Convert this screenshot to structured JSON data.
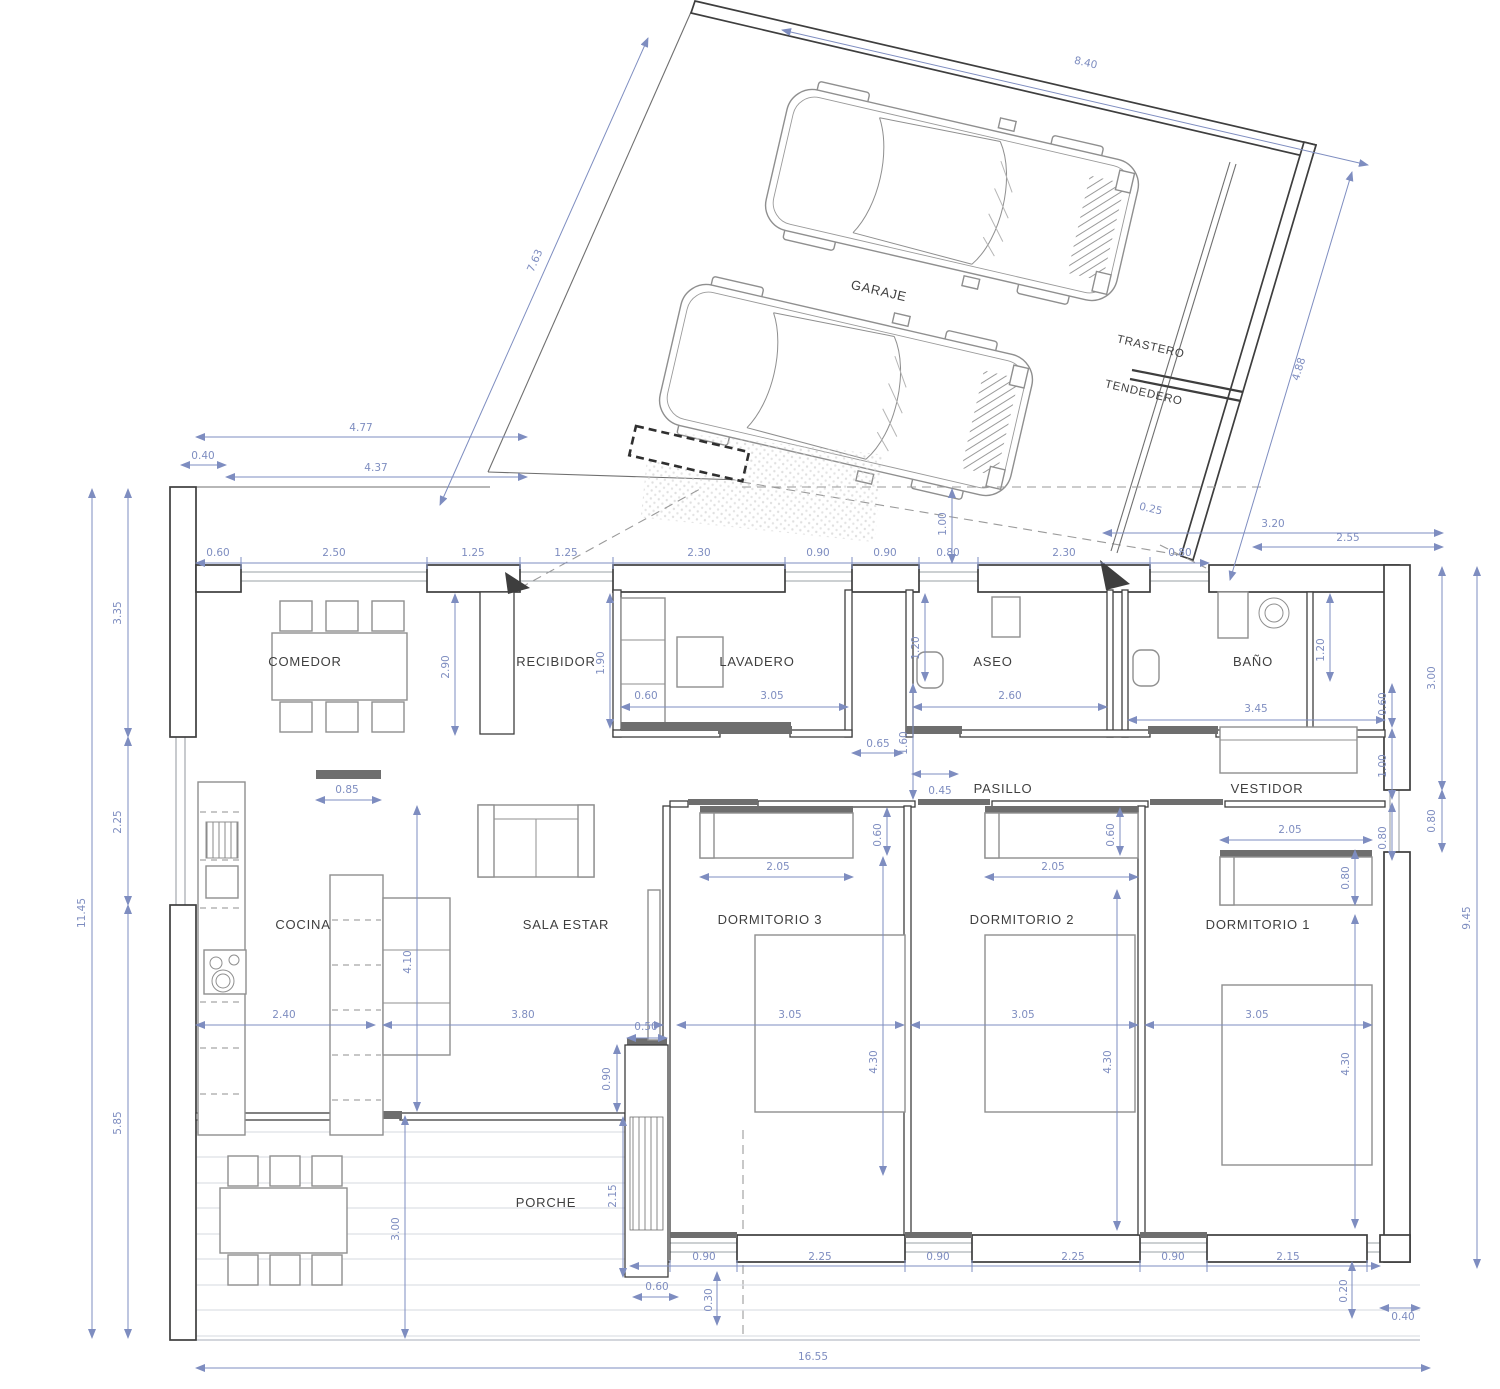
{
  "rooms": {
    "garaje": "GARAJE",
    "trastero": "TRASTERO",
    "tendedero": "TENDEDERO",
    "comedor": "COMEDOR",
    "recibidor": "RECIBIDOR",
    "lavadero": "LAVADERO",
    "aseo": "ASEO",
    "bano": "BAÑO",
    "pasillo": "PASILLO",
    "vestidor": "VESTIDOR",
    "cocina": "COCINA",
    "sala_estar": "SALA ESTAR",
    "dormitorio3": "DORMITORIO 3",
    "dormitorio2": "DORMITORIO 2",
    "dormitorio1": "DORMITORIO 1",
    "porche": "PORCHE"
  },
  "dims": {
    "plot_top": [
      "4.77",
      "0.40",
      "4.37",
      "1.00"
    ],
    "garage": [
      "8.40",
      "7.63",
      "4.88",
      "0.25"
    ],
    "top_chain": [
      "0.60",
      "2.50",
      "1.25",
      "1.25",
      "2.30",
      "0.90",
      "0.90",
      "0.80",
      "2.30",
      "0.80",
      "2.55",
      "3.20"
    ],
    "left_chain": [
      "3.35",
      "2.25",
      "5.85",
      "11.45"
    ],
    "right_chain": [
      "3.00",
      "0.80",
      "9.45"
    ],
    "bottom_chain": [
      "0.90",
      "2.25",
      "0.90",
      "2.25",
      "0.90",
      "2.15",
      "0.60",
      "0.30",
      "0.20",
      "0.40",
      "16.55"
    ],
    "interior": [
      "2.90",
      "1.90",
      "0.60",
      "3.05",
      "1.20",
      "2.60",
      "0.65",
      "0.45",
      "1.60",
      "3.45",
      "1.20",
      "0.60",
      "1.00",
      "0.80",
      "2.05",
      "2.05",
      "2.05",
      "0.60",
      "0.60",
      "0.80",
      "3.05",
      "3.05",
      "3.05",
      "4.30",
      "4.30",
      "4.30",
      "0.85",
      "2.40",
      "3.80",
      "4.10",
      "0.50",
      "0.90",
      "2.15",
      "3.00"
    ]
  },
  "colors": {
    "dimension": "#7e8dc0",
    "wall": "#3e3e3e",
    "furniture": "#8f8f8f",
    "door": "#6e6e6e",
    "deck": "#dde0e5"
  }
}
